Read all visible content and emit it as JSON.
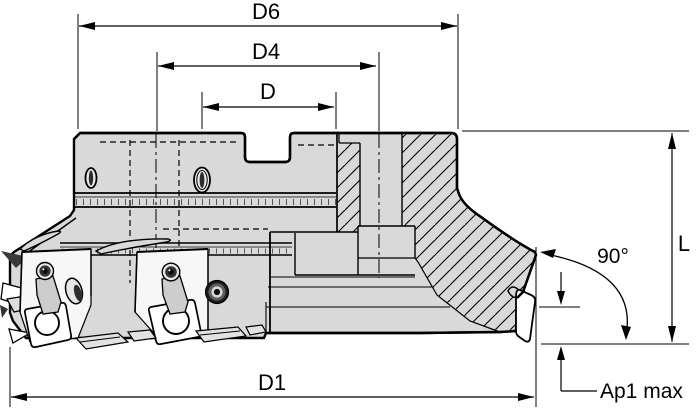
{
  "drawing": {
    "labels": {
      "d6": "D6",
      "d4": "D4",
      "d": "D",
      "d1": "D1",
      "length": "L",
      "angle": "90°",
      "ap1": "Ap1 max"
    },
    "colors": {
      "background": "#ffffff",
      "body_fill": "#d9d9d9",
      "outline": "#000000",
      "insert_fill": "#ffffff",
      "pocket_fill": "#f7f7f7"
    }
  }
}
